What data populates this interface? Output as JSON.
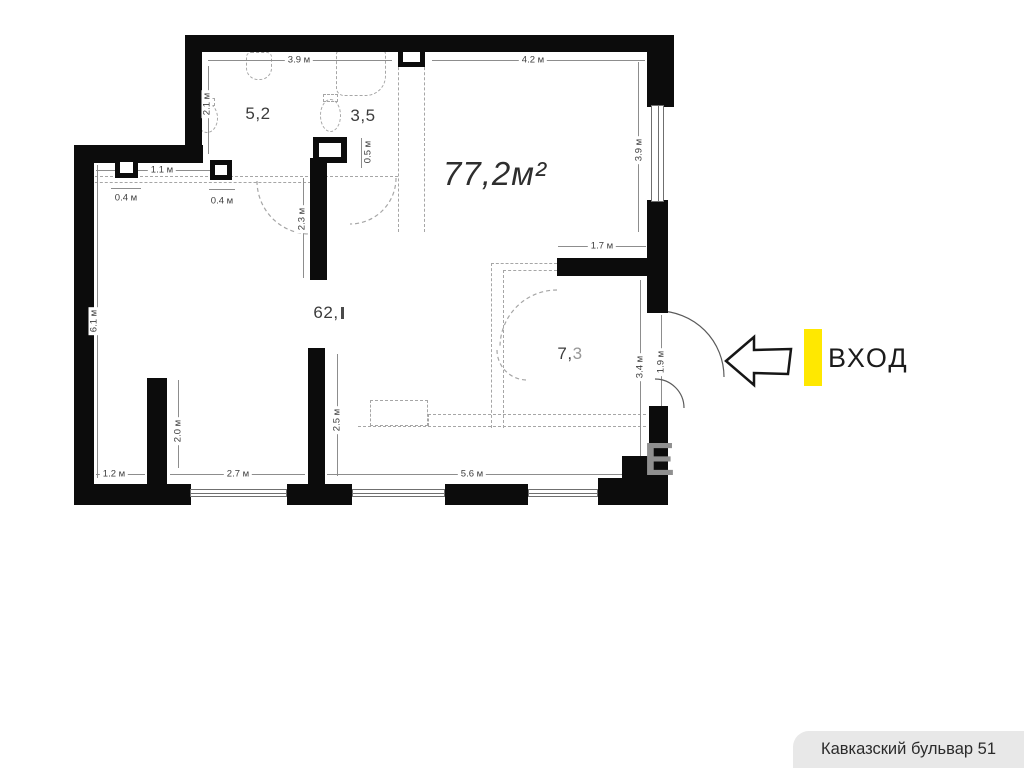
{
  "colors": {
    "wall": "#0c0c0c",
    "accent_yellow": "#ffe800",
    "dimension_text": "#3d3d3d",
    "footer_bg": "#e8e8e8",
    "watermark_gray": "#8f8f8f"
  },
  "plan": {
    "total_area_label": "77,2м²",
    "rooms": {
      "r52": "5,2",
      "r35": "3,5",
      "r62": "62,",
      "r73_dark": "7,",
      "r73_light": "3"
    },
    "dims": {
      "top_left": "3.9 м",
      "top_right": "4.2 м",
      "v21": "2.1 м",
      "v05": "0.5 м",
      "h11": "1.1 м",
      "h04a": "0.4 м",
      "h04b": "0.4 м",
      "v23": "2.3 м",
      "v39r": "3.9 м",
      "h17": "1.7 м",
      "v61": "6.1 м",
      "v34": "3.4 м",
      "v19": "1.9 м",
      "v20": "2.0 м",
      "v25": "2.5 м",
      "h12": "1.2 м",
      "h27": "2.7 м",
      "h56": "5.6 м"
    }
  },
  "entrance": {
    "label": "ВХОД"
  },
  "watermark": {
    "letter": "Е"
  },
  "footer": {
    "address": "Кавказский бульвар 51"
  }
}
